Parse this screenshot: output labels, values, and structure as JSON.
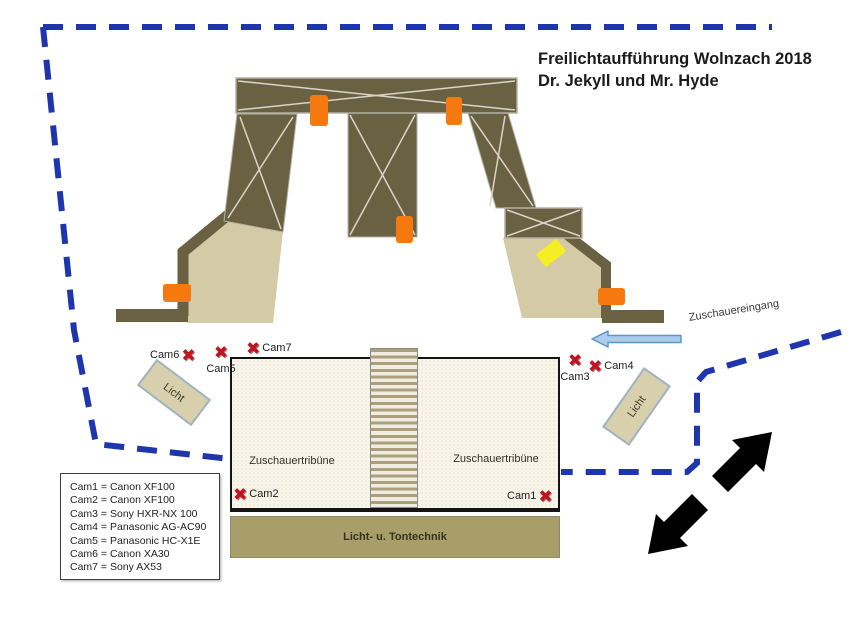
{
  "title": {
    "line1": "Freilichtaufführung Wolnzach 2018",
    "line2": "Dr. Jekyll und Mr. Hyde"
  },
  "labels": {
    "tribune_left": "Zuschauertribüne",
    "tribune_right": "Zuschauertribüne",
    "tech": "Licht- u. Tontechnik",
    "light_left": "Licht",
    "light_right": "Licht",
    "entrance": "Zuschauereingang"
  },
  "cams": {
    "cam1": "Cam1",
    "cam2": "Cam2",
    "cam3": "Cam3",
    "cam4": "Cam4",
    "cam5": "Cam5",
    "cam6": "Cam6",
    "cam7": "Cam7"
  },
  "marker_glyph": "✖",
  "legend": {
    "items": [
      "Cam1 = Canon XF100",
      "Cam2 = Canon XF100",
      "Cam3 = Sony HXR-NX 100",
      "Cam4 = Panasonic AG-AC90",
      "Cam5 = Panasonic HC-X1E",
      "Cam6 = Canon XA30",
      "Cam7 = Sony AX53"
    ]
  },
  "colors": {
    "truss_olive": "#6a6143",
    "floor_tan": "#d4cba6",
    "marker_orange": "#f5790f",
    "marker_yellow": "#f6ee25",
    "perimeter_blue": "#1e35ae",
    "camera_x_red": "#c01420",
    "entrance_arrow_fill": "#a9cdeb",
    "entrance_arrow_border": "#5e96cd",
    "exit_arrow_black": "#000000"
  }
}
